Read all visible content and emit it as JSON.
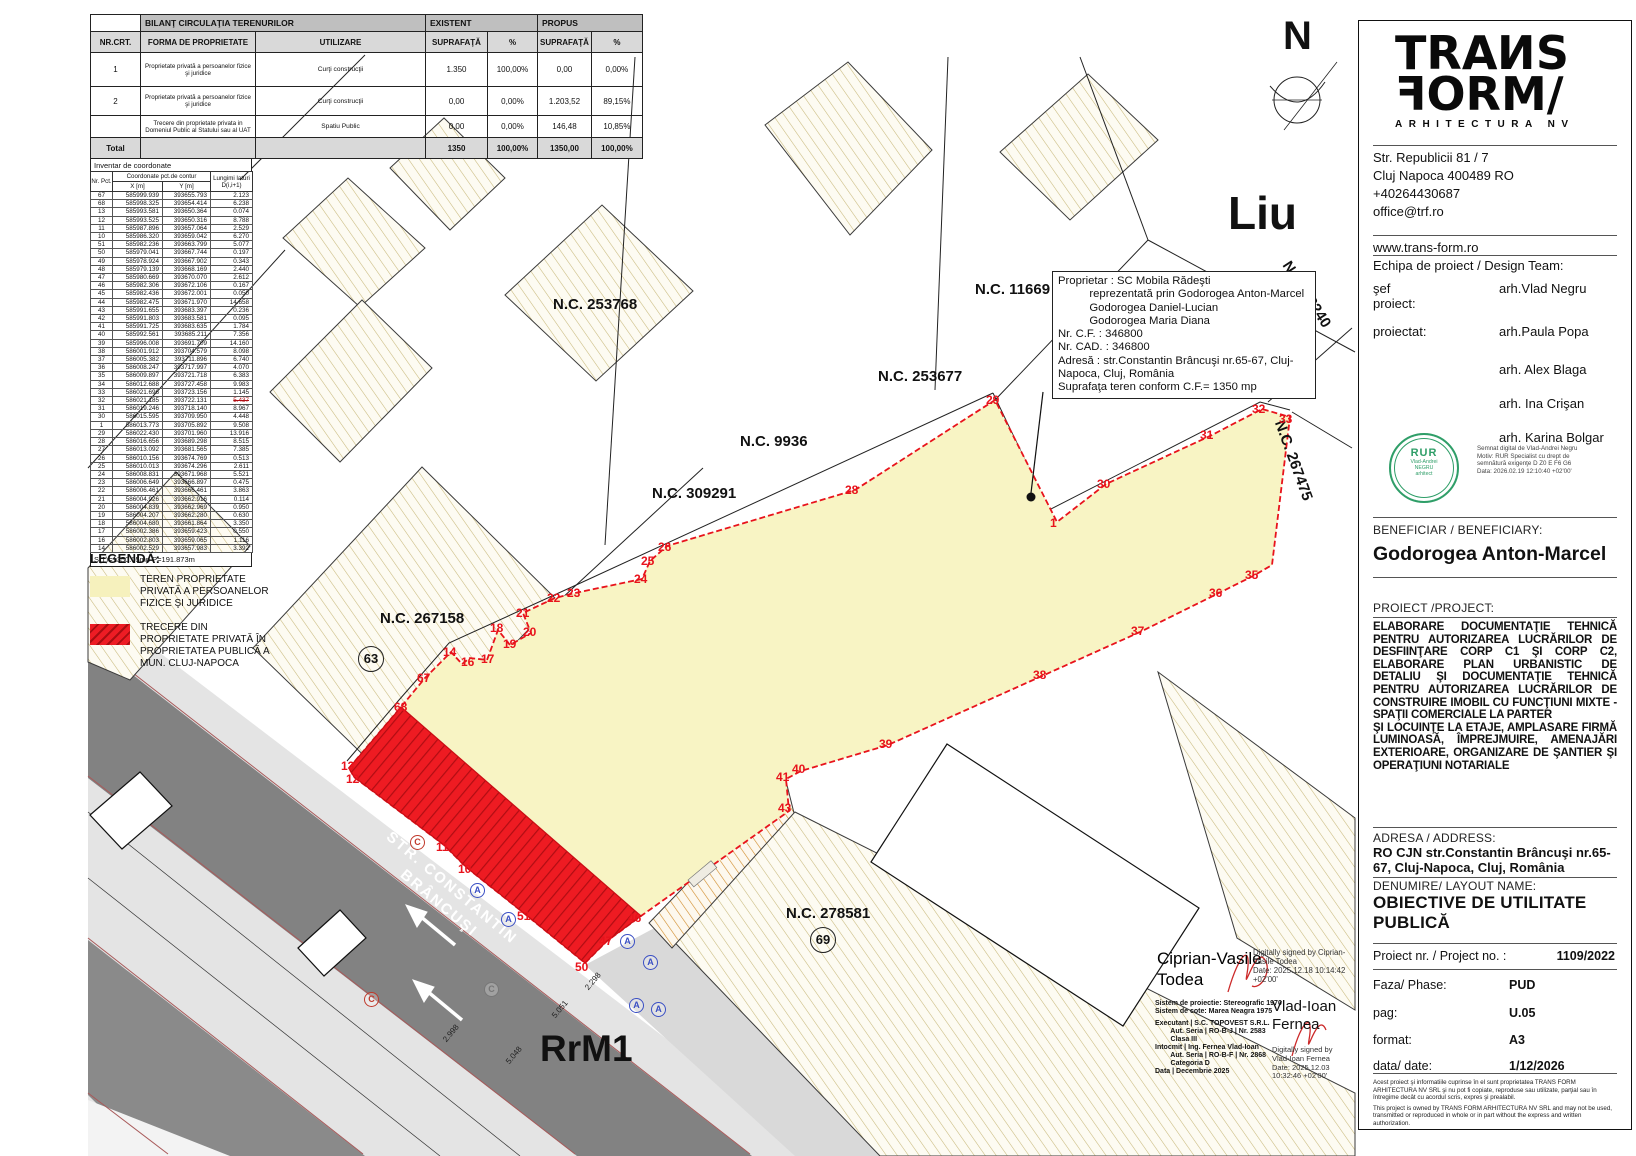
{
  "colors": {
    "accent_red": "#ed1c24",
    "parcel_yellow": "#f8f4c4",
    "road_gray": "#828282",
    "hatch_tan": "#c8b87a",
    "stamp_green": "#2f9e68",
    "point_red": "#e8131c"
  },
  "bilant": {
    "title": "BILANŢ CIRCULAŢIA TERENURILOR",
    "existent": "EXISTENT",
    "propus": "PROPUS",
    "headers": [
      "NR.CRT.",
      "FORMA DE PROPRIETATE",
      "UTILIZARE",
      "SUPRAFAŢĂ",
      "%",
      "SUPRAFAŢĂ",
      "%"
    ],
    "rows": [
      [
        "1",
        "Proprietate privată a persoanelor fizice şi juridice",
        "Curţi construcţii",
        "1.350",
        "100,00%",
        "0,00",
        "0,00%"
      ],
      [
        "2",
        "Proprietate privată a persoanelor fizice şi juridice",
        "Curţi construcţii",
        "0,00",
        "0,00%",
        "1.203,52",
        "89,15%"
      ],
      [
        "",
        "Trecere din proprietate privata in Domeniul Public al Statului sau al UAT",
        "Spatiu Public",
        "0,00",
        "0,00%",
        "146,48",
        "10,85%"
      ]
    ],
    "total": [
      "Total",
      "",
      "",
      "1350",
      "100,00%",
      "1350,00",
      "100,00%"
    ]
  },
  "coord": {
    "title": "Inventar de coordonate",
    "col_nr": "Nr. Pct.",
    "col_coords": "Coordonate pct.de contur",
    "col_x": "X [m]",
    "col_y": "Y [m]",
    "col_len": "Lungimi laturi D(i,i+1)",
    "strike_nr": "32",
    "rows": [
      [
        "67",
        "585999.939",
        "393655.793",
        "2.123"
      ],
      [
        "68",
        "585998.325",
        "393654.414",
        "6.238"
      ],
      [
        "13",
        "585993.581",
        "393650.364",
        "0.074"
      ],
      [
        "12",
        "585993.525",
        "393650.316",
        "8.788"
      ],
      [
        "11",
        "585987.896",
        "393657.064",
        "2.529"
      ],
      [
        "10",
        "585986.320",
        "393659.042",
        "6.270"
      ],
      [
        "51",
        "585982.236",
        "393663.799",
        "5.077"
      ],
      [
        "50",
        "585979.041",
        "393667.744",
        "0.197"
      ],
      [
        "49",
        "585978.924",
        "393667.902",
        "0.343"
      ],
      [
        "48",
        "585979.139",
        "393668.169",
        "2.440"
      ],
      [
        "47",
        "585980.669",
        "393670.070",
        "2.612"
      ],
      [
        "46",
        "585982.306",
        "393672.106",
        "0.167"
      ],
      [
        "45",
        "585982.436",
        "393672.001",
        "0.050"
      ],
      [
        "44",
        "585982.475",
        "393671.970",
        "14.658"
      ],
      [
        "43",
        "585991.655",
        "393683.397",
        "0.236"
      ],
      [
        "42",
        "585991.803",
        "393683.581",
        "0.095"
      ],
      [
        "41",
        "585991.725",
        "393683.635",
        "1.784"
      ],
      [
        "40",
        "585992.561",
        "393685.211",
        "7.356"
      ],
      [
        "39",
        "585996.008",
        "393691.709",
        "14.160"
      ],
      [
        "38",
        "586001.912",
        "393704.579",
        "8.098"
      ],
      [
        "37",
        "586005.382",
        "393711.896",
        "6.740"
      ],
      [
        "36",
        "586008.247",
        "393717.997",
        "4.070"
      ],
      [
        "35",
        "586009.897",
        "393721.718",
        "6.383"
      ],
      [
        "34",
        "586012.688",
        "393727.458",
        "9.983"
      ],
      [
        "33",
        "586021.696",
        "393723.156",
        "1.145"
      ],
      [
        "32",
        "586021.185",
        "393722.131",
        "5.437"
      ],
      [
        "31",
        "586019.246",
        "393718.140",
        "8.967"
      ],
      [
        "30",
        "586015.595",
        "393709.950",
        "4.448"
      ],
      [
        "1",
        "586013.773",
        "393705.892",
        "9.508"
      ],
      [
        "29",
        "586022.430",
        "393701.960",
        "13.916"
      ],
      [
        "28",
        "586016.656",
        "393689.298",
        "8.515"
      ],
      [
        "27",
        "586013.092",
        "393681.565",
        "7.385"
      ],
      [
        "26",
        "586010.156",
        "393674.769",
        "0.513"
      ],
      [
        "25",
        "586010.013",
        "393674.296",
        "2.611"
      ],
      [
        "24",
        "586008.831",
        "393671.968",
        "5.521"
      ],
      [
        "23",
        "586006.649",
        "393666.897",
        "0.475"
      ],
      [
        "22",
        "586006.461",
        "393666.461",
        "3.863"
      ],
      [
        "21",
        "586004.926",
        "393662.916",
        "0.114"
      ],
      [
        "20",
        "586004.839",
        "393662.969",
        "0.950"
      ],
      [
        "19",
        "586004.207",
        "393662.280",
        "0.630"
      ],
      [
        "18",
        "586004.680",
        "393661.864",
        "3.350"
      ],
      [
        "17",
        "586002.386",
        "393659.423",
        "0.550"
      ],
      [
        "16",
        "586002.803",
        "393659.065",
        "1.116"
      ],
      [
        "14",
        "586002.529",
        "393657.983",
        "3.392"
      ]
    ],
    "footer": "S(1)=1350.05mp  P=191.873m"
  },
  "legend": {
    "title": "LEGENDĂ:",
    "items": [
      {
        "label": "TEREN PROPRIETATE PRIVATĂ A PERSOANELOR FIZICE ŞI JURIDICE",
        "type": "solid"
      },
      {
        "label": "TRECERE DIN PROPRIETATE PRIVATĂ ÎN PROPRIETATEA PUBLICĂ A MUN. CLUJ-NAPOCA",
        "type": "hatched"
      }
    ]
  },
  "owner_box": {
    "lines": [
      "Proprietar : SC Mobila Rădeşti",
      "          reprezentată prin Godorogea Anton-Marcel",
      "          Godorogea Daniel-Lucian",
      "          Godorogea Maria Diana",
      "Nr. C.F. : 346800",
      "Nr. CAD. : 346800",
      "Adresă : str.Constantin Brâncuşi nr.65-67, Cluj-",
      "Napoca, Cluj, România",
      "Suprafaţa teren conform C.F.= 1350 mp"
    ]
  },
  "map": {
    "labels": [
      {
        "t": "N.C. 253768",
        "x": 553,
        "y": 296
      },
      {
        "t": "N.C. 11669",
        "x": 975,
        "y": 281
      },
      {
        "t": "N.C. 253677",
        "x": 878,
        "y": 368
      },
      {
        "t": "N.C. 9936",
        "x": 740,
        "y": 433
      },
      {
        "t": "N.C. 309291",
        "x": 652,
        "y": 485
      },
      {
        "t": "N.C. 267158",
        "x": 380,
        "y": 610
      },
      {
        "t": "N.C. 278581",
        "x": 786,
        "y": 905
      },
      {
        "t": "N.C. 28240",
        "x": 1293,
        "y": 258,
        "rot": 57
      },
      {
        "t": "N.C. 267475",
        "x": 1287,
        "y": 418,
        "rot": 70
      },
      {
        "t": "Liu",
        "x": 1228,
        "y": 186,
        "s": 46
      },
      {
        "t": "RrM1",
        "x": 540,
        "y": 1028,
        "s": 37
      },
      {
        "t": "N",
        "x": 1283,
        "y": 14,
        "s": 40
      }
    ],
    "street": [
      "STR. CONSTANTIN",
      "BRÂNCUŞI"
    ],
    "circled_numbers": [
      {
        "t": "63",
        "x": 358,
        "y": 646
      },
      {
        "t": "69",
        "x": 810,
        "y": 927
      }
    ],
    "points": [
      [
        "29",
        986,
        393
      ],
      [
        "28",
        845,
        483
      ],
      [
        "26",
        658,
        540
      ],
      [
        "25",
        641,
        554
      ],
      [
        "24",
        634,
        572
      ],
      [
        "23",
        567,
        586
      ],
      [
        "22",
        547,
        591
      ],
      [
        "21",
        516,
        606
      ],
      [
        "20",
        523,
        625
      ],
      [
        "19",
        503,
        637
      ],
      [
        "18",
        490,
        621
      ],
      [
        "17",
        481,
        652
      ],
      [
        "16",
        461,
        655
      ],
      [
        "14",
        443,
        645
      ],
      [
        "67",
        417,
        671
      ],
      [
        "68",
        394,
        700
      ],
      [
        "13",
        341,
        759
      ],
      [
        "12",
        346,
        772
      ],
      [
        "11",
        436,
        840
      ],
      [
        "10",
        458,
        862
      ],
      [
        "51",
        517,
        909
      ],
      [
        "50",
        575,
        960
      ],
      [
        "47",
        599,
        934
      ],
      [
        "46",
        628,
        911
      ],
      [
        "43",
        778,
        801
      ],
      [
        "41",
        776,
        770
      ],
      [
        "40",
        792,
        762
      ],
      [
        "39",
        879,
        737
      ],
      [
        "38",
        1033,
        668
      ],
      [
        "37",
        1131,
        624
      ],
      [
        "36",
        1209,
        586
      ],
      [
        "35",
        1245,
        568
      ],
      [
        "33",
        1279,
        412
      ],
      [
        "32",
        1252,
        402
      ],
      [
        "31",
        1200,
        428
      ],
      [
        "30",
        1097,
        477
      ],
      [
        "1",
        1050,
        516
      ]
    ],
    "dims": [
      [
        "2.998",
        441,
        1038
      ],
      [
        "5.048",
        504,
        1060
      ],
      [
        "5.051",
        550,
        1014
      ],
      [
        "2.298",
        583,
        986
      ]
    ],
    "letters": [
      [
        "A",
        470,
        883,
        "blue"
      ],
      [
        "A",
        501,
        912,
        "blue"
      ],
      [
        "A",
        620,
        934,
        "blue"
      ],
      [
        "A",
        643,
        955,
        "blue"
      ],
      [
        "A",
        629,
        998,
        "blue"
      ],
      [
        "A",
        651,
        1002,
        "blue"
      ],
      [
        "C",
        410,
        835,
        "red"
      ],
      [
        "C",
        484,
        982,
        "gray"
      ],
      [
        "C",
        364,
        992,
        "red"
      ]
    ]
  },
  "surveyor": {
    "name1": [
      "Ciprian-Vasile",
      "Todea"
    ],
    "sig1": [
      "Digitally signed by Ciprian-",
      "Vasile Todea",
      "Date: 2025.12.18 10:14:42",
      "+02'00'"
    ],
    "systems": [
      "Sistem de proiectie: Stereografic 1970",
      "Sistem de cote: Marea Neagra 1975"
    ],
    "exec": [
      "Executant | S.C. TOPOVEST S.R.L.",
      "        Aut. Seria | RO-B-J | Nr. 2583",
      "        Clasa III",
      "Intocmit | Ing. Fernea Vlad-Ioan",
      "        Aut. Seria | RO-B-F | Nr. 2868",
      "        Categoria D",
      "Data | Decembrie 2025"
    ],
    "name2": [
      "Vlad-Ioan",
      "Fernea"
    ],
    "sig2": [
      "Digitally signed by",
      "Vlad-Ioan Fernea",
      "Date: 2025.12.03",
      "10:32:46 +02'00'"
    ]
  },
  "titleblock": {
    "logo": {
      "line1": "TRANS",
      "line2": "FORM/",
      "tagline": "ARHITECTURA NV"
    },
    "contact": [
      "Str. Republicii 81 / 7",
      "Cluj Napoca 400489 RO",
      "+40264430687",
      "office@trf.ro"
    ],
    "website": "www.trans-form.ro",
    "team_label": "Echipa de proiect / Design Team:",
    "team": [
      {
        "role": "şef proiect:",
        "name": "arh.Vlad Negru"
      },
      {
        "role": "proiectat:",
        "name": "arh.Paula Popa"
      },
      {
        "role": "",
        "name": "arh. Alex Blaga"
      },
      {
        "role": "",
        "name": "arh. Ina Crişan"
      },
      {
        "role": "",
        "name": "arh. Karina Bolgar"
      }
    ],
    "stamp": {
      "big": "RUR",
      "small": [
        "Vlad-Andrei",
        "NEGRU",
        "arhitect"
      ]
    },
    "stamp_note": [
      "Semnat digital de Vlad-Andrei Negru",
      "Motiv: RUR Specialist cu drept de",
      "semnătură exigenţe D Z0 E F6 G6",
      "Data: 2026.02.19 12:10:40 +02'00'"
    ],
    "beneficiar_label": "BENEFICIAR / BENEFICIARY:",
    "beneficiar": "Godorogea Anton-Marcel",
    "proiect_label": "PROIECT /PROJECT:",
    "proiect_p1": "ELABORARE DOCUMENTAŢIE TEHNICĂ PENTRU AUTORIZAREA LUCRĂRILOR DE DESFIINŢARE CORP C1 ŞI CORP C2, ELABORARE PLAN URBANISTIC DE DETALIU ŞI DOCUMENTAŢIE TEHNICĂ PENTRU AUTORIZAREA LUCRĂRILOR DE CONSTRUIRE IMOBIL CU FUNCŢIUNI MIXTE - SPAŢII COMERCIALE LA PARTER",
    "proiect_p2": "ŞI LOCUINŢE LA ETAJE, AMPLASARE FIRMĂ LUMINOASĂ, ÎMPREJMUIRE, AMENAJĂRI EXTERIOARE, ORGANIZARE DE ŞANTIER ŞI OPERAŢIUNI NOTARIALE",
    "adresa_label": "ADRESA / ADDRESS:",
    "adresa": "RO CJN  str.Constantin Brâncuşi nr.65-67, Cluj-Napoca, Cluj, România",
    "denumire_label": "DENUMIRE/ LAYOUT NAME:",
    "denumire": "OBIECTIVE DE UTILITATE PUBLICĂ",
    "fields": [
      {
        "label": "Proiect nr. / Project no. :",
        "value": "1109/2022",
        "right": true
      },
      {
        "label": "Faza/ Phase:",
        "value": "PUD"
      },
      {
        "label": "pag:",
        "value": "U.05"
      },
      {
        "label": "format:",
        "value": "A3"
      },
      {
        "label": "data/ date:",
        "value": "1/12/2026"
      }
    ],
    "disclaimer": [
      "Acest proiect şi informatiile cuprinse în el sunt proprietatea TRANS FORM ARHITECTURA NV SRL şi nu pot fi copiate, reproduse sau utilizate, parţial sau în întregime decât cu acordul scris, expres şi prealabil.",
      "This project is owned by TRANS FORM ARHITECTURA NV SRL and may not be used, transmitted or reproduced in whole or in part without the express and written authorization."
    ]
  }
}
